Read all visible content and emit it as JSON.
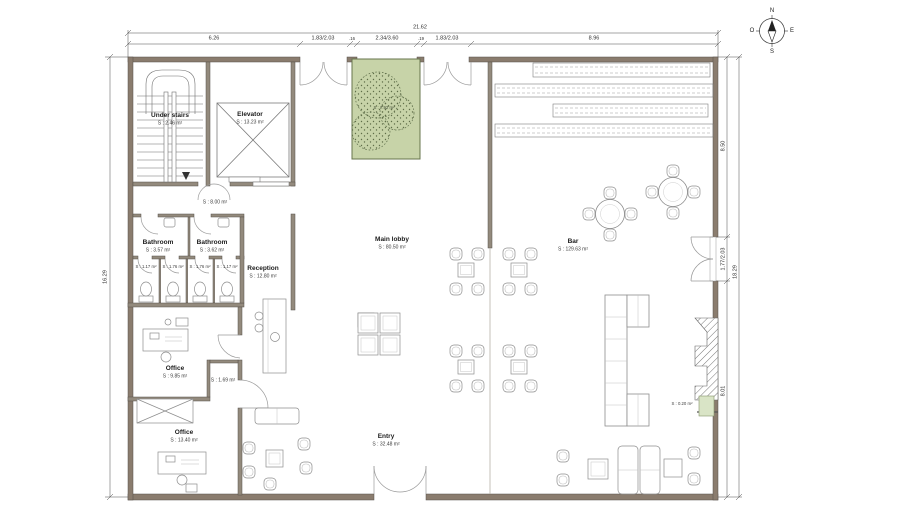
{
  "compass": {
    "north": "N",
    "south": "S",
    "west": "O",
    "east": "E"
  },
  "dimensions": {
    "top_total": "21.62",
    "top_segments": [
      "6.26",
      "1.83/2.03",
      ".16",
      "2.34/3.60",
      ".19",
      "1.83/2.03",
      "8.96"
    ],
    "left_total": "16.29",
    "right_total": "18.29",
    "right_segments": [
      "8.50",
      "1.77/2.03",
      "8.01"
    ]
  },
  "rooms": {
    "under_stairs": {
      "name": "Under stairs",
      "area": "S : 2.46 m²"
    },
    "elevator": {
      "name": "Elevator",
      "area": "S : 13.23 m²"
    },
    "hall": {
      "area": "S : 8.00 m²"
    },
    "bathroom_left": {
      "name": "Bathroom",
      "area": "S : 3.57 m²"
    },
    "bathroom_right": {
      "name": "Bathroom",
      "area": "S : 3.62 m²"
    },
    "stall_1": {
      "area": "S : 1.17 m²"
    },
    "stall_2": {
      "area": "S : 1.76 m²"
    },
    "stall_3": {
      "area": "S : 1.76 m²"
    },
    "stall_4": {
      "area": "S : 1.17 m²"
    },
    "reception": {
      "name": "Reception",
      "area": "S : 12.80 m²"
    },
    "office_top": {
      "name": "Office",
      "area": "S : 9.85 m²"
    },
    "vestibule": {
      "area": "S : 1.69 m²"
    },
    "office_bottom": {
      "name": "Office",
      "area": "S : 13.40 m²"
    },
    "main_lobby": {
      "name": "Main lobby",
      "area": "S : 80.50 m²"
    },
    "bar": {
      "name": "Bar",
      "area": "S : 129.63 m²"
    },
    "entry": {
      "name": "Entry",
      "area": "S : 32.48 m²"
    },
    "planter": {
      "area": "S : 7.92 m²"
    },
    "planter_small": {
      "area": "S : 0.20 m²"
    }
  },
  "colors": {
    "wall": "#8a7c6e",
    "wall_interior": "#938a7d",
    "planter_fill": "#c7d3a8",
    "planter_stroke": "#67754d",
    "furniture": "#8d8d8d",
    "dimension": "#3a3a3a"
  }
}
